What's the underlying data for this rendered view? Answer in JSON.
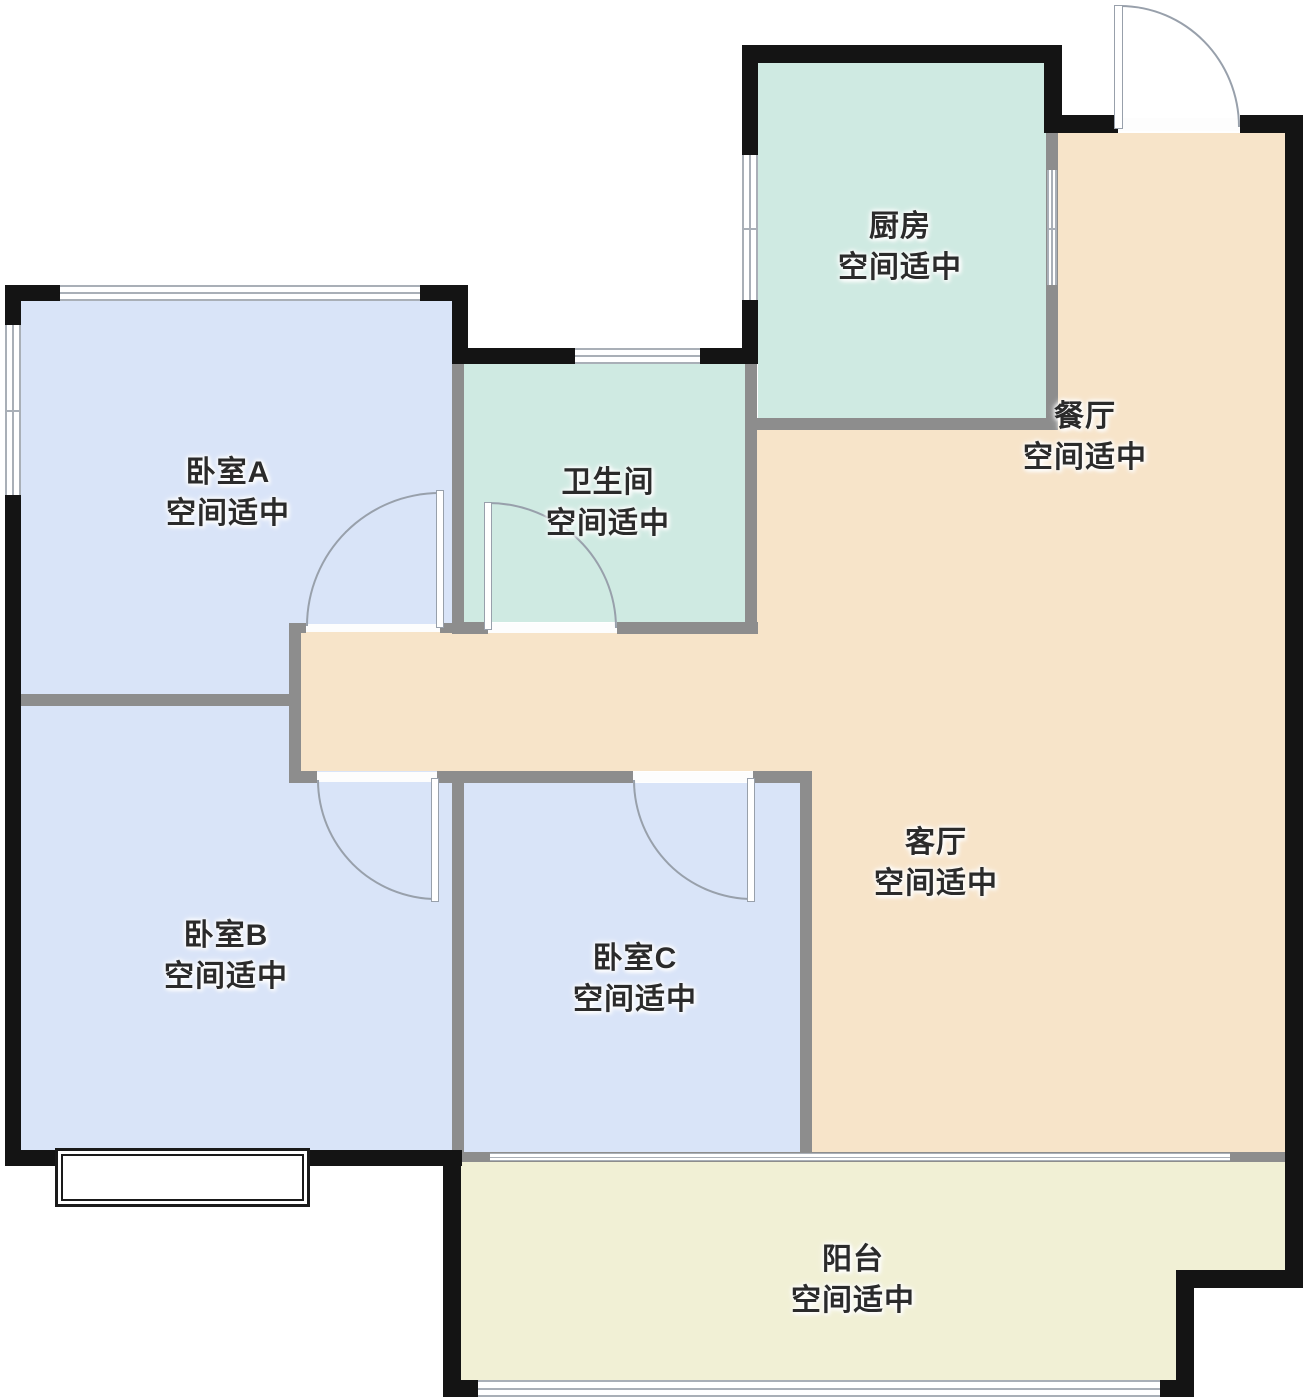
{
  "plan": {
    "type": "apartment-floor-plan",
    "status_text_shared": "空间适中"
  },
  "rooms": [
    {
      "id": "bedroom-a",
      "name": "卧室A",
      "status": "空间适中"
    },
    {
      "id": "bedroom-b",
      "name": "卧室B",
      "status": "空间适中"
    },
    {
      "id": "bedroom-c",
      "name": "卧室C",
      "status": "空间适中"
    },
    {
      "id": "bathroom",
      "name": "卫生间",
      "status": "空间适中"
    },
    {
      "id": "kitchen",
      "name": "厨房",
      "status": "空间适中"
    },
    {
      "id": "dining",
      "name": "餐厅",
      "status": "空间适中"
    },
    {
      "id": "living",
      "name": "客厅",
      "status": "空间适中"
    },
    {
      "id": "balcony",
      "name": "阳台",
      "status": "空间适中"
    }
  ],
  "colors": {
    "bedroom": "#d9e4f8",
    "wet_area": "#cfeae2",
    "living_dining": "#f7e4c9",
    "balcony": "#f1f0d5",
    "exterior_wall": "#141414",
    "interior_wall": "#8d8d8d",
    "door_arc": "#98a0ab"
  }
}
